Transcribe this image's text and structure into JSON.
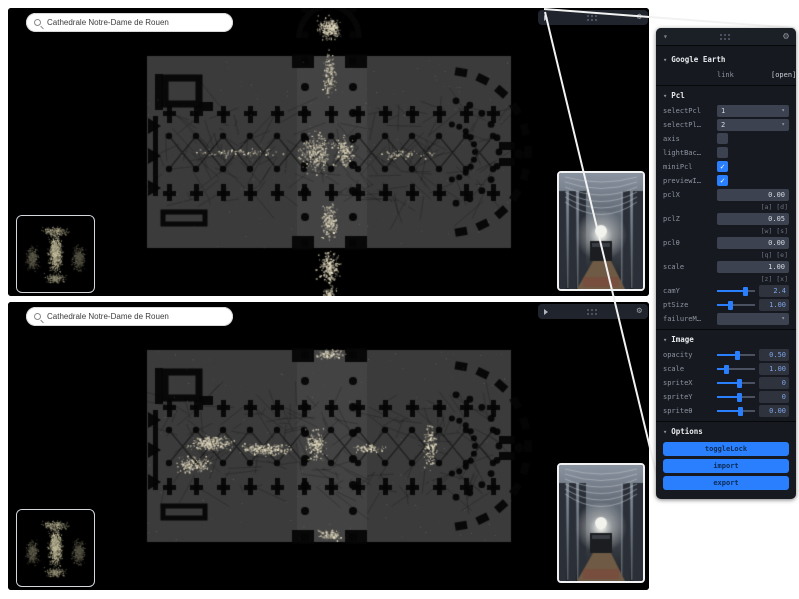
{
  "search": {
    "value": "Cathedrale Notre-Dame de Rouen"
  },
  "icons": {
    "chevron_down": "▾",
    "gear": "⚙",
    "check": "✓",
    "caret": "▾"
  },
  "panel": {
    "sections": [
      {
        "title": "Google Earth",
        "rows": [
          {
            "type": "monitor",
            "label": "link",
            "value": "[open]"
          }
        ]
      },
      {
        "title": "Pcl",
        "rows": [
          {
            "type": "select",
            "label": "selectPcl",
            "value": "1"
          },
          {
            "type": "select",
            "label": "selectPl…",
            "value": "2"
          },
          {
            "type": "checkbox",
            "label": "axis",
            "checked": false
          },
          {
            "type": "checkbox",
            "label": "lightBac…",
            "checked": false
          },
          {
            "type": "checkbox",
            "label": "miniPcl",
            "checked": true
          },
          {
            "type": "checkbox",
            "label": "previewI…",
            "checked": true
          },
          {
            "type": "text",
            "label": "pclX",
            "value": "0.00",
            "hint": "[a] [d]"
          },
          {
            "type": "text",
            "label": "pclZ",
            "value": "0.05",
            "hint": "[w] [s]"
          },
          {
            "type": "text",
            "label": "pclθ",
            "value": "0.00",
            "hint": "[q] [e]"
          },
          {
            "type": "text",
            "label": "scale",
            "value": "1.00",
            "hint": "[z] [x]"
          },
          {
            "type": "slider",
            "label": "camY",
            "value": "2.4",
            "frac": 0.74
          },
          {
            "type": "slider",
            "label": "ptSize",
            "value": "1.00",
            "frac": 0.35
          },
          {
            "type": "select",
            "label": "failureM…",
            "value": ""
          }
        ]
      },
      {
        "title": "Image",
        "rows": [
          {
            "type": "slider",
            "label": "opacity",
            "value": "0.50",
            "frac": 0.55
          },
          {
            "type": "slider",
            "label": "scale",
            "value": "1.00",
            "frac": 0.25
          },
          {
            "type": "slider",
            "label": "spriteX",
            "value": "0",
            "frac": 0.6
          },
          {
            "type": "slider",
            "label": "spriteY",
            "value": "0",
            "frac": 0.6
          },
          {
            "type": "slider",
            "label": "spriteθ",
            "value": "0.00",
            "frac": 0.62
          }
        ]
      },
      {
        "title": "Options",
        "buttons": [
          "toggleLock",
          "import",
          "export"
        ]
      }
    ]
  }
}
